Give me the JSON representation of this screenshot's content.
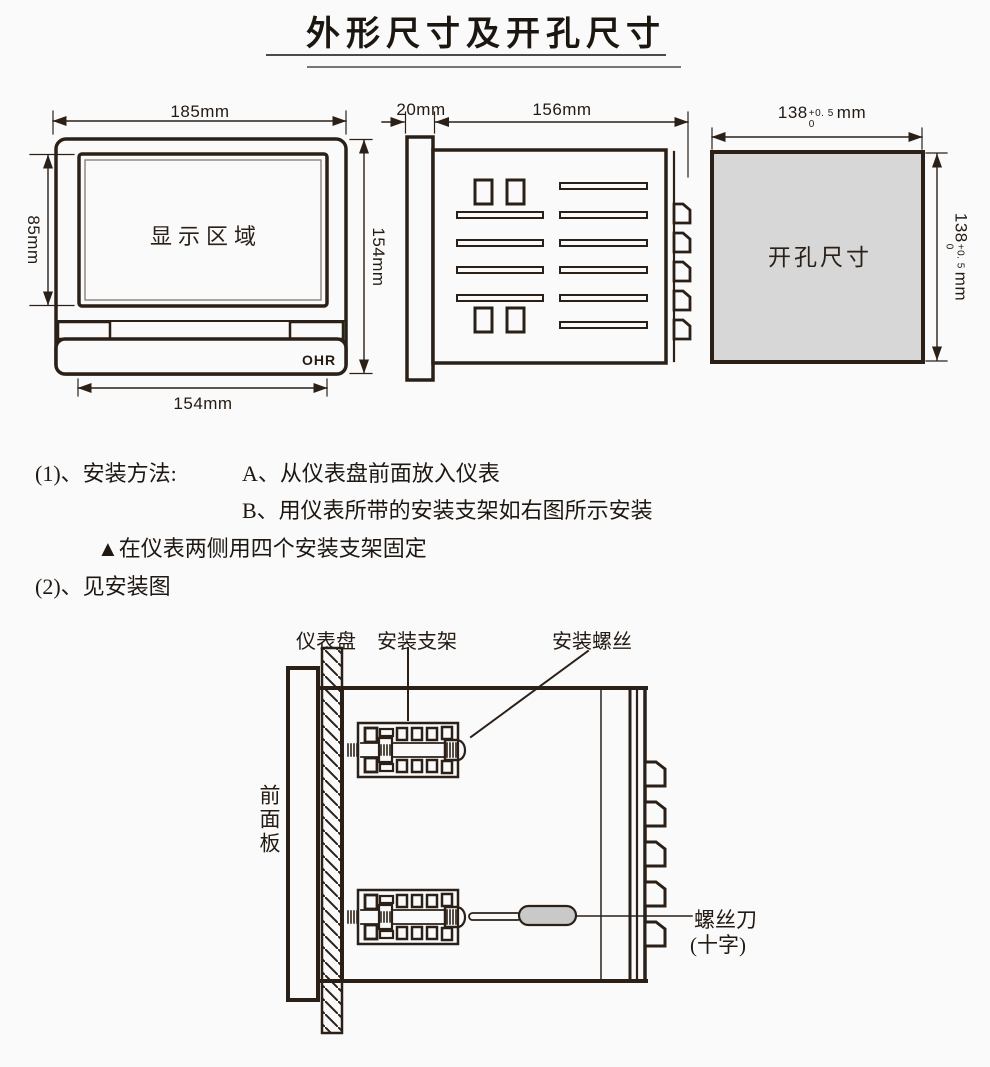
{
  "title": "外形尺寸及开孔尺寸",
  "front_view": {
    "width_label": "185mm",
    "display_height_label": "85mm",
    "height_label": "154mm",
    "body_width_label": "154mm",
    "display_area": "显示区域",
    "logo": "OHR"
  },
  "side_view": {
    "front_depth_label": "20mm",
    "body_depth_label": "156mm"
  },
  "cutout_view": {
    "area_label": "开孔尺寸",
    "width_dim": {
      "value": "138",
      "tol_upper": "+0. 5",
      "tol_lower": "0",
      "unit": "mm"
    },
    "height_dim": {
      "value": "138",
      "tol_upper": "+0. 5",
      "tol_lower": "0",
      "unit": "mm"
    }
  },
  "instructions": {
    "item1_label": "(1)、安装方法:",
    "step_a": "A、从仪表盘前面放入仪表",
    "step_b": "B、用仪表所带的安装支架如右图所示安装",
    "note": "▲在仪表两侧用四个安装支架固定",
    "item2_label": "(2)、见安装图"
  },
  "install_diagram": {
    "panel_label": "仪表盘",
    "bracket_label": "安装支架",
    "screw_label": "安装螺丝",
    "front_panel_label": "前面板",
    "screwdriver_label": "螺丝刀",
    "screwdriver_type_label": "(十字)"
  },
  "colors": {
    "ink": "#2b2018",
    "cutout_fill": "#d7d7d7",
    "screwdriver_handle_fill": "#c9c9c9"
  }
}
